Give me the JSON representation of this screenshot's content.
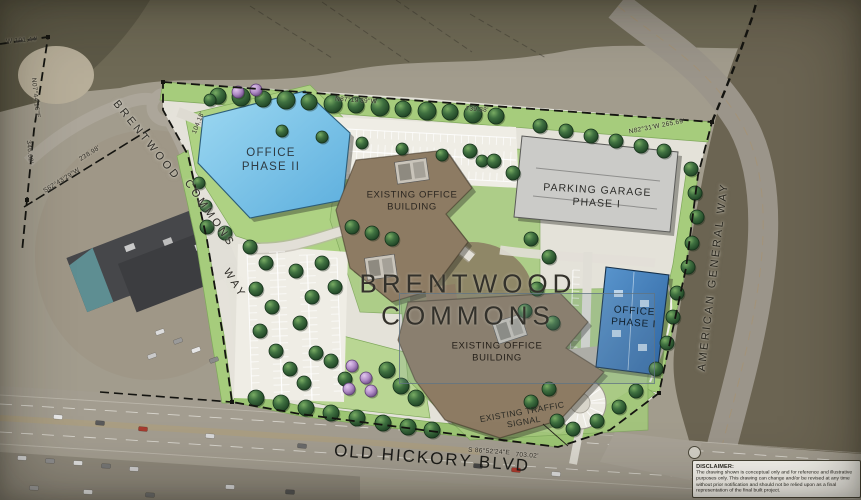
{
  "site": {
    "title_line1": "BRENTWOOD",
    "title_line2": "COMMONS"
  },
  "buildings": {
    "office_phase_2_line1": "OFFICE",
    "office_phase_2_line2": "PHASE II",
    "existing_north_line1": "EXISTING OFFICE",
    "existing_north_line2": "BUILDING",
    "parking_garage_line1": "PARKING GARAGE",
    "parking_garage_line2": "PHASE I",
    "existing_south_line1": "EXISTING OFFICE",
    "existing_south_line2": "BUILDING",
    "office_phase_1_line1": "OFFICE",
    "office_phase_1_line2": "PHASE I"
  },
  "roads": {
    "brentwood": "BRENTWOOD",
    "commons": "COMMONS",
    "way": "WAY",
    "old_hickory_blvd": "OLD HICKORY BLVD",
    "american_general_way": "AMERICAN GENERAL WAY"
  },
  "annotations": {
    "traffic_signal_line1": "EXISTING TRAFFIC",
    "traffic_signal_line2": "SIGNAL"
  },
  "survey_dimensions": {
    "west_top": "W 191.44'",
    "west_bearing": "N07°44'16\"E",
    "west_length": "346.62'",
    "southwest_bearing": "S62°43'29\"W",
    "southwest_length": "238.98'",
    "northwest_length": "104.18'",
    "north_bearing": "N87°19'39\"W",
    "north_length": "739.38'",
    "northeast_bearing": "N82°31'W 265.69'",
    "south_bearing": "S 86°52'24\"E",
    "south_length": "703.02'"
  },
  "disclaimer": {
    "heading": "DISCLAIMER:",
    "body": "The drawing shown is conceptual only and for reference and illustrative purposes only. This drawing can change and/or be revised at any time without prior notification and should not be relied upon as a final representation of the final built project."
  },
  "colors": {
    "office_phase_2_fill": "#7ec5e8",
    "office_phase_1_fill": "#3d7dbd",
    "existing_building_fill": "#8d7b63",
    "parking_garage_fill": "#cbcbc8",
    "landscape_green": "#a6cc7c",
    "paving": "#e6e4dc"
  }
}
